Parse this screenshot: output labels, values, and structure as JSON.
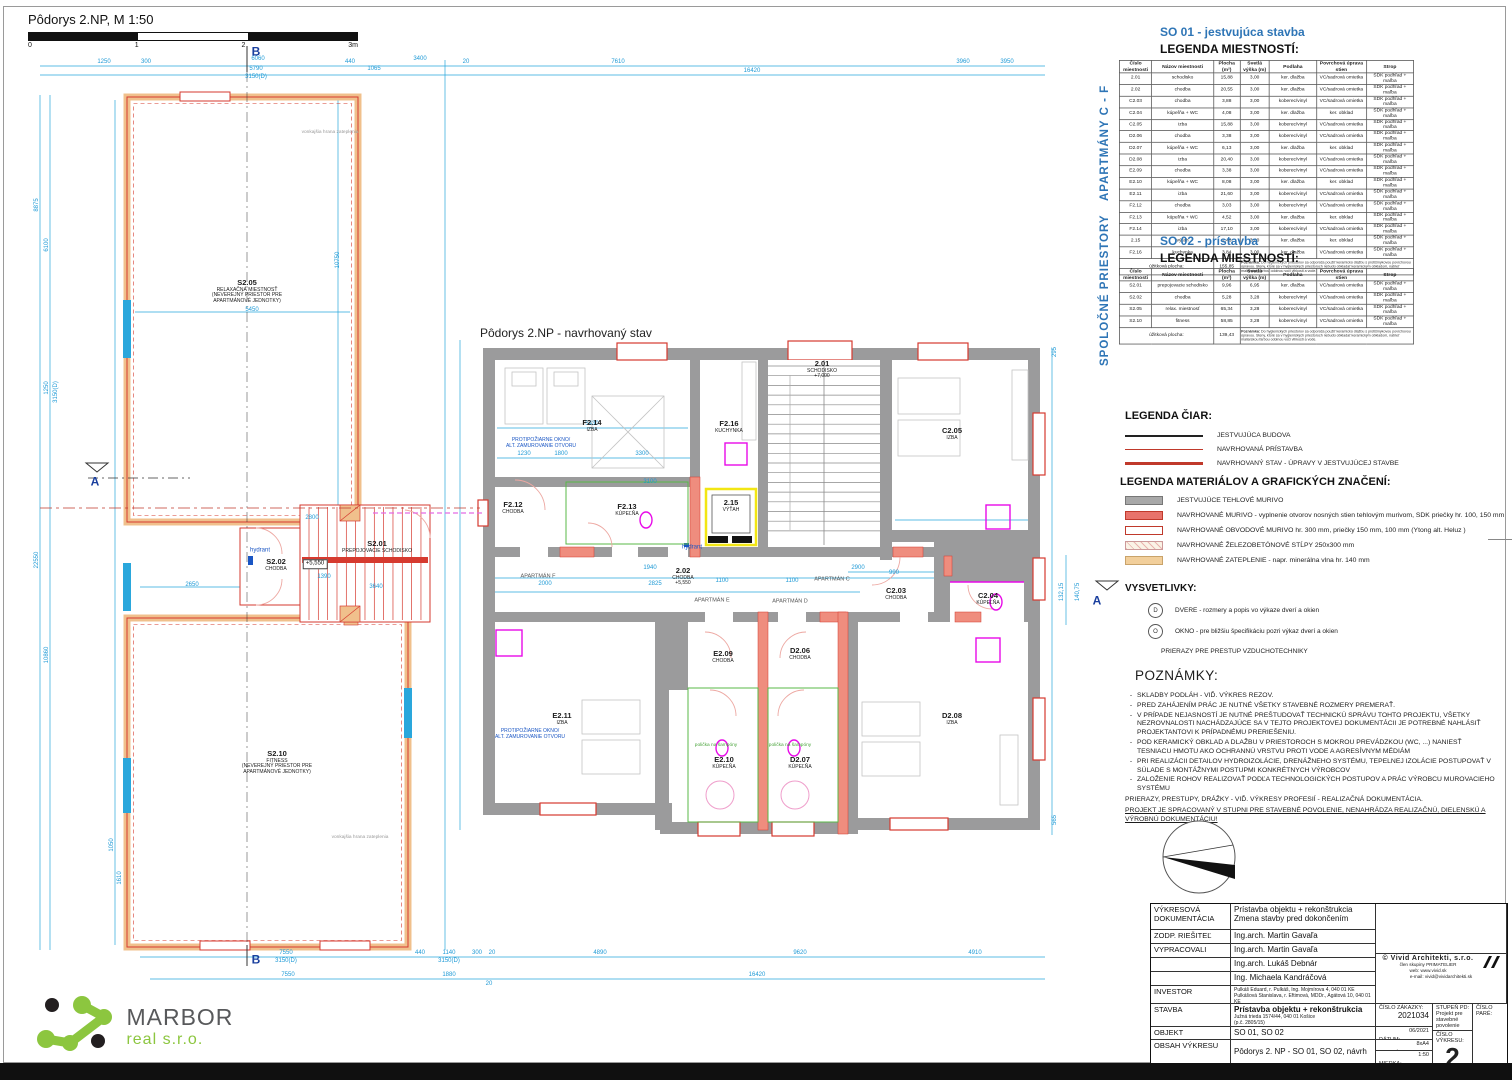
{
  "page": {
    "title": "Pôdorys 2.NP, M 1:50",
    "scale_ticks": [
      "0",
      "1",
      "2",
      "3m"
    ],
    "plan_title": "Pôdorys 2.NP - navrhovaný stav"
  },
  "colors": {
    "cyan": "#1f9ad6",
    "red": "#d63a2f",
    "salmon": "#ef8d7e",
    "tan": "#f0c08c",
    "gray_wall": "#9b9b9c",
    "blue_heading": "#2e75b6",
    "magenta": "#e80ae8",
    "green": "#58b847",
    "yellow": "#f2e613"
  },
  "side_labels": {
    "apartmany": "APARTMÁNY C - F",
    "spolocne": "SPOLOČNÉ PRIESTORY"
  },
  "so01": {
    "heading": "SO 01 - jestvujúca stavba",
    "subheading": "LEGENDA MIESTNOSTÍ:"
  },
  "so02": {
    "heading": "SO 02 - prístavba",
    "subheading": "LEGENDA MIESTNOSTÍ:"
  },
  "tables": {
    "headers": [
      "Číslo miestnosti",
      "Názov miestnosti",
      "Plocha (m²)",
      "Svetlá výška (m)",
      "Podlaha",
      "Povrchová úprava stien",
      "Strop"
    ],
    "so01": {
      "rows": [
        [
          "2.01",
          "schodisko",
          "15,88",
          "3,00",
          "ker. dlažba",
          "VC/sadrová omietka",
          "SDK podhľad + maľba"
        ],
        [
          "2.02",
          "chodba",
          "20,55",
          "3,00",
          "ker. dlažba",
          "VC/sadrová omietka",
          "SDK podhľad + maľba"
        ],
        [
          "C2.03",
          "chodba",
          "3,88",
          "3,00",
          "koberec/vinyl",
          "VC/sadrová omietka",
          "SDK podhľad + maľba"
        ],
        [
          "C2.04",
          "kúpeľňa + WC",
          "4,08",
          "3,00",
          "ker. dlažba",
          "ker. obklad",
          "SDK podhľad + maľba"
        ],
        [
          "C2.05",
          "izba",
          "15,88",
          "3,00",
          "koberec/vinyl",
          "VC/sadrová omietka",
          "SDK podhľad + maľba"
        ],
        [
          "D2.06",
          "chodba",
          "3,38",
          "3,00",
          "koberec/vinyl",
          "VC/sadrová omietka",
          "SDK podhľad + maľba"
        ],
        [
          "D2.07",
          "kúpeľňa + WC",
          "6,13",
          "3,00",
          "ker. dlažba",
          "ker. obklad",
          "SDK podhľad + maľba"
        ],
        [
          "D2.08",
          "izba",
          "20,40",
          "3,00",
          "koberec/vinyl",
          "VC/sadrová omietka",
          "SDK podhľad + maľba"
        ],
        [
          "E2.09",
          "chodba",
          "3,38",
          "3,00",
          "koberec/vinyl",
          "VC/sadrová omietka",
          "SDK podhľad + maľba"
        ],
        [
          "E2.10",
          "kúpeľňa + WC",
          "8,08",
          "3,00",
          "ker. dlažba",
          "ker. obklad",
          "SDK podhľad + maľba"
        ],
        [
          "E2.11",
          "izba",
          "21,60",
          "3,00",
          "koberec/vinyl",
          "VC/sadrová omietka",
          "SDK podhľad + maľba"
        ],
        [
          "F2.12",
          "chodba",
          "3,03",
          "3,00",
          "koberec/vinyl",
          "VC/sadrová omietka",
          "SDK podhľad + maľba"
        ],
        [
          "F2.13",
          "kúpeľňa + WC",
          "4,52",
          "3,00",
          "ker. dlažba",
          "ker. obklad",
          "SDK podhľad + maľba"
        ],
        [
          "F2.14",
          "izba",
          "17,10",
          "3,00",
          "koberec/vinyl",
          "VC/sadrová omietka",
          "SDK podhľad + maľba"
        ],
        [
          "2.15",
          "výťah",
          "2,48",
          "3,00",
          "ker. dlažba",
          "ker. obklad",
          "SDK podhľad + maľba"
        ],
        [
          "F2.16",
          "kuchynka",
          "3,84",
          "3,00",
          "ker. dlažba",
          "VC/sadrová omietka",
          "SDK podhľad + maľba"
        ]
      ],
      "footer": {
        "label": "úžitková plocha:",
        "value": "155,85",
        "note_label": "Poznámka:",
        "note": "Do hygienických priestorov sa odporúča použiť keramickú dlažbu s protišmykovou povrchovou úpravou. Steny, ktoré sa v hygienických priestoroch nebudú obkladať keramickým obkladom, natrieť maliarskou farbou odolnou voči vlhkosti a vode."
      }
    },
    "so02": {
      "rows": [
        [
          "S2.01",
          "prepojovacie schodisko",
          "9,96",
          "6,95",
          "ker. dlažba",
          "VC/sadrová omietka",
          "SDK podhľad + maľba"
        ],
        [
          "S2.02",
          "chodba",
          "5,28",
          "3,28",
          "koberec/vinyl",
          "VC/sadrová omietka",
          "SDK podhľad + maľba"
        ],
        [
          "S2.05",
          "relax. miestnosť",
          "65,34",
          "3,28",
          "koberec/vinyl",
          "VC/sadrová omietka",
          "SDK podhľad + maľba"
        ],
        [
          "S2.10",
          "fitness",
          "58,85",
          "3,28",
          "koberec/vinyl",
          "VC/sadrová omietka",
          "SDK podhľad + maľba"
        ]
      ],
      "footer": {
        "label": "úžitková plocha:",
        "value": "139,43",
        "note_label": "Poznámka:",
        "note": "Do hygienických priestorov sa odporúča použiť keramickú dlažbu s protišmykovou povrchovou úpravou. Steny, ktoré sa v hygienických priestoroch nebudú obkladať keramickým obkladom, natrieť maliarskou farbou odolnou voči vlhkosti a vode."
      }
    }
  },
  "legend_lines": {
    "title": "LEGENDA ČIAR:",
    "items": [
      {
        "label": "JESTVUJÚCA BUDOVA",
        "color": "#222222",
        "weight": 2
      },
      {
        "label": "NAVRHOVANÁ PRÍSTAVBA",
        "color": "#c0392b",
        "weight": 1
      },
      {
        "label": "NAVRHOVANÝ STAV - ÚPRAVY V JESTVUJÚCEJ STAVBE",
        "color": "#c0392b",
        "weight": 3
      }
    ]
  },
  "legend_materials": {
    "title": "LEGENDA MATERIÁLOV A GRAFICKÝCH ZNAČENÍ:",
    "items": [
      {
        "swatch": "gray-fill",
        "label": "JESTVUJÚCE TEHLOVÉ MURIVO"
      },
      {
        "swatch": "red-fill",
        "label": "NAVRHOVANÉ MURIVO - vyplnenie otvorov nosných stien tehlovým murivom, SDK priečky hr. 100, 150 mm"
      },
      {
        "swatch": "red-outline",
        "label": "NAVRHOVANÉ OBVODOVÉ MURIVO hr. 300 mm, priečky 150 mm, 100 mm (Ytong alt. Heluz )"
      },
      {
        "swatch": "hatch",
        "label": "NAVRHOVANÉ ŽELEZOBETÓNOVÉ STĹPY 250x300 mm"
      },
      {
        "swatch": "tan-fill",
        "label": "NAVRHOVANÉ ZATEPLENIE - napr. minerálna vlna hr. 140 mm"
      }
    ]
  },
  "vysvetlivky": {
    "title": "VYSVETLIVKY:",
    "marker": "A",
    "items": [
      {
        "sym": "D",
        "text": "DVERE - rozmery a popis vo výkaze dverí a okien"
      },
      {
        "sym": "O",
        "text": "OKNO - pre bližšiu špecifikáciu pozri výkaz dverí a okien"
      }
    ],
    "extra": "PRIERAZY PRE PRESTUP VZDUCHOTECHNIKY"
  },
  "poznamky": {
    "title": "POZNÁMKY:",
    "bullets": [
      "SKLADBY PODLÁH - VIĎ. VÝKRES REZOV.",
      "PRED ZAHÁJENÍM PRÁC JE NUTNÉ VŠETKY STAVEBNÉ ROZMERY PREMERAŤ.",
      "V PRÍPADE NEJASNOSTÍ JE NUTNÉ PREŠTUDOVAŤ TECHNICKÚ SPRÁVU TOHTO PROJEKTU, VŠETKY NEZROVNALOSTI NACHÁDZAJÚCE SA V TEJTO PROJEKTOVEJ DOKUMENTÁCII JE POTREBNÉ NAHLÁSIŤ PROJEKTANTOVI K PRÍPADNÉMU PRERIEŠENIU.",
      "POD KERAMICKÝ OBKLAD A DLAŽBU V PRIESTOROCH S MOKROU PREVÁDZKOU (WC, ...) NANIESŤ TESNIACU HMOTU AKO OCHRANNÚ VRSTVU PROTI VODE A AGRESÍVNYM MÉDIÁM",
      "PRI REALIZÁCII DETAILOV HYDROIZOLÁCIE, DRENÁŽNEHO SYSTÉMU, TEPELNEJ IZOLÁCIE POSTUPOVAŤ V SÚLADE S MONTÁŽNYMI POSTUPMI KONKRÉTNYCH VÝROBCOV",
      "ZALOŽENIE ROHOV REALIZOVAŤ PODĽA TECHNOLOGICKÝCH POSTUPOV A PRÁC VÝROBCU MUROVACIEHO SYSTÉMU"
    ],
    "line1": "PRIERAZY, PRESTUPY, DRÁŽKY - VIĎ. VÝKRESY PROFESIÍ - REALIZAČNÁ DOKUMENTÁCIA.",
    "line2": "PROJEKT JE SPRACOVANÝ V STUPNI PRE STAVEBNÉ POVOLENIE, NENAHRÁDZA REALIZAČNÚ, DIELENSKÚ A VÝROBNÚ DOKUMENTÁCIU!"
  },
  "rooms": [
    {
      "num": "F2.14",
      "name": "IZBA",
      "sub": [],
      "x": 592,
      "y": 426
    },
    {
      "num": "F2.16",
      "name": "KUCHYNKA",
      "sub": [],
      "x": 729,
      "y": 427
    },
    {
      "num": "F2.12",
      "name": "CHODBA",
      "sub": [],
      "x": 513,
      "y": 508
    },
    {
      "num": "F2.13",
      "name": "KÚPEĽŇA",
      "sub": [],
      "x": 627,
      "y": 510
    },
    {
      "num": "2.15",
      "name": "VÝŤAH",
      "sub": [],
      "x": 731,
      "y": 506
    },
    {
      "num": "2.01",
      "name": "SCHODISKO",
      "sub": [
        "+7,000"
      ],
      "x": 822,
      "y": 370
    },
    {
      "num": "C2.05",
      "name": "IZBA",
      "sub": [],
      "x": 952,
      "y": 434
    },
    {
      "num": "C2.03",
      "name": "CHODBA",
      "sub": [],
      "x": 896,
      "y": 594
    },
    {
      "num": "C2.04",
      "name": "KÚPEĽŇA",
      "sub": [],
      "x": 988,
      "y": 599
    },
    {
      "num": "2.02",
      "name": "CHODBA",
      "sub": [
        "+5,550"
      ],
      "x": 683,
      "y": 577
    },
    {
      "num": "E2.09",
      "name": "CHODBA",
      "sub": [],
      "x": 723,
      "y": 657
    },
    {
      "num": "D2.06",
      "name": "CHODBA",
      "sub": [],
      "x": 800,
      "y": 654
    },
    {
      "num": "E2.11",
      "name": "IZBA",
      "sub": [],
      "x": 562,
      "y": 719
    },
    {
      "num": "E2.10",
      "name": "KÚPEĽŇA",
      "sub": [],
      "x": 724,
      "y": 763
    },
    {
      "num": "D2.07",
      "name": "KÚPEĽŇA",
      "sub": [],
      "x": 800,
      "y": 763
    },
    {
      "num": "D2.08",
      "name": "IZBA",
      "sub": [],
      "x": 952,
      "y": 719
    },
    {
      "num": "S2.05",
      "name": "RELAXAČNÁ MIESTNOSŤ",
      "sub": [
        "(NEVEREJNÝ PRIESTOR PRE",
        "APARTMÁNOVÉ JEDNOTKY)"
      ],
      "x": 247,
      "y": 292
    },
    {
      "num": "S2.02",
      "name": "CHODBA",
      "sub": [],
      "x": 276,
      "y": 565
    },
    {
      "num": "S2.01",
      "name": "PREPOJOVACIE SCHODISKO",
      "sub": [],
      "x": 377,
      "y": 547
    },
    {
      "num": "S2.10",
      "name": "FITNESS",
      "sub": [
        "(NEVEREJNÝ PRIESTOR PRE",
        "APARTMÁNOVÉ JEDNOTKY)"
      ],
      "x": 277,
      "y": 763
    }
  ],
  "labels": [
    {
      "cls": "hydrant",
      "t": "hydrant",
      "x": 260,
      "y": 551
    },
    {
      "cls": "hydrant",
      "t": "hydrant",
      "x": 692,
      "y": 548
    },
    {
      "cls": "bluenote",
      "t": "PROTIPOŽIARNE OKNO/\nALT. ZAMUROVANIE OTVORU",
      "x": 541,
      "y": 443
    },
    {
      "cls": "bluenote",
      "t": "PROTIPOŽIARNE OKNO/\nALT. ZAMUROVANIE OTVORU",
      "x": 530,
      "y": 734
    },
    {
      "cls": "greennote",
      "t": "polička na šampóny",
      "x": 716,
      "y": 746
    },
    {
      "cls": "greennote",
      "t": "polička na šampóny",
      "x": 790,
      "y": 746
    },
    {
      "cls": "graynote",
      "t": "vonkajšia hrana zateplenia",
      "x": 330,
      "y": 133
    },
    {
      "cls": "graynote",
      "t": "vonkajšia hrana zateplenia",
      "x": 360,
      "y": 838
    },
    {
      "cls": "apt",
      "t": "APARTMÁN F",
      "x": 538,
      "y": 577
    },
    {
      "cls": "apt",
      "t": "APARTMÁN E",
      "x": 712,
      "y": 601
    },
    {
      "cls": "apt",
      "t": "APARTMÁN D",
      "x": 790,
      "y": 602
    },
    {
      "cls": "apt",
      "t": "APARTMÁN C",
      "x": 832,
      "y": 580
    },
    {
      "cls": "level",
      "t": "+5,550",
      "x": 315,
      "y": 564
    },
    {
      "cls": "secmark",
      "t": "B",
      "x": 256,
      "y": 52
    },
    {
      "cls": "secmark",
      "t": "B",
      "x": 256,
      "y": 960
    },
    {
      "cls": "secmark",
      "t": "A",
      "x": 95,
      "y": 482
    },
    {
      "cls": "secmark",
      "t": "A",
      "x": 1097,
      "y": 601
    }
  ],
  "dims": [
    {
      "t": "1250",
      "x": 104,
      "y": 62
    },
    {
      "t": "300",
      "x": 146,
      "y": 62
    },
    {
      "t": "6060",
      "x": 258,
      "y": 59
    },
    {
      "t": "5790",
      "x": 256,
      "y": 69
    },
    {
      "t": "3150(D)",
      "x": 256,
      "y": 77
    },
    {
      "t": "440",
      "x": 350,
      "y": 62
    },
    {
      "t": "3400",
      "x": 420,
      "y": 59
    },
    {
      "t": "1065",
      "x": 374,
      "y": 69
    },
    {
      "t": "20",
      "x": 466,
      "y": 62
    },
    {
      "t": "7610",
      "x": 618,
      "y": 62
    },
    {
      "t": "16420",
      "x": 752,
      "y": 71
    },
    {
      "t": "3960",
      "x": 963,
      "y": 62
    },
    {
      "t": "3950",
      "x": 1007,
      "y": 62
    },
    {
      "t": "8875",
      "x": 37,
      "y": 205,
      "r": 1
    },
    {
      "t": "6100",
      "x": 47,
      "y": 245,
      "r": 1
    },
    {
      "t": "1250",
      "x": 47,
      "y": 388,
      "r": 1
    },
    {
      "t": "3150(D)",
      "x": 56,
      "y": 392,
      "r": 1
    },
    {
      "t": "22550",
      "x": 37,
      "y": 560,
      "r": 1
    },
    {
      "t": "10860",
      "x": 47,
      "y": 655,
      "r": 1
    },
    {
      "t": "1610",
      "x": 120,
      "y": 878,
      "r": 1
    },
    {
      "t": "1050",
      "x": 112,
      "y": 845,
      "r": 1
    },
    {
      "t": "7550",
      "x": 286,
      "y": 953
    },
    {
      "t": "3150(D)",
      "x": 286,
      "y": 961
    },
    {
      "t": "440",
      "x": 420,
      "y": 953
    },
    {
      "t": "1140",
      "x": 449,
      "y": 953
    },
    {
      "t": "3150(D)",
      "x": 449,
      "y": 961
    },
    {
      "t": "300",
      "x": 477,
      "y": 953
    },
    {
      "t": "20",
      "x": 492,
      "y": 953
    },
    {
      "t": "4890",
      "x": 600,
      "y": 953
    },
    {
      "t": "9620",
      "x": 800,
      "y": 953
    },
    {
      "t": "4910",
      "x": 975,
      "y": 953
    },
    {
      "t": "7550",
      "x": 288,
      "y": 975
    },
    {
      "t": "1880",
      "x": 449,
      "y": 975
    },
    {
      "t": "20",
      "x": 489,
      "y": 984
    },
    {
      "t": "16420",
      "x": 757,
      "y": 975
    },
    {
      "t": "295",
      "x": 1055,
      "y": 352,
      "r": 1
    },
    {
      "t": "132,15",
      "x": 1062,
      "y": 592,
      "r": 1
    },
    {
      "t": "140,75",
      "x": 1078,
      "y": 592,
      "r": 1
    },
    {
      "t": "565",
      "x": 1055,
      "y": 820,
      "r": 1
    },
    {
      "t": "5430",
      "x": 592,
      "y": 424
    },
    {
      "t": "1230",
      "x": 524,
      "y": 454
    },
    {
      "t": "1800",
      "x": 561,
      "y": 454
    },
    {
      "t": "3300",
      "x": 642,
      "y": 454
    },
    {
      "t": "3100",
      "x": 650,
      "y": 482
    },
    {
      "t": "2000",
      "x": 545,
      "y": 584
    },
    {
      "t": "2825",
      "x": 655,
      "y": 584
    },
    {
      "t": "1100",
      "x": 722,
      "y": 581
    },
    {
      "t": "1100",
      "x": 792,
      "y": 581
    },
    {
      "t": "2900",
      "x": 858,
      "y": 568
    },
    {
      "t": "990",
      "x": 894,
      "y": 573
    },
    {
      "t": "1940",
      "x": 650,
      "y": 568
    },
    {
      "t": "5450",
      "x": 252,
      "y": 310
    },
    {
      "t": "2800",
      "x": 312,
      "y": 518
    },
    {
      "t": "2650",
      "x": 192,
      "y": 585
    },
    {
      "t": "3640",
      "x": 376,
      "y": 587
    },
    {
      "t": "1390",
      "x": 324,
      "y": 577
    },
    {
      "t": "10750",
      "x": 338,
      "y": 260,
      "r": 1
    }
  ],
  "titleblock": {
    "doc_label": "VÝKRESOVÁ DOKUMENTÁCIA",
    "doc_value1": "Prístavba objektu + rekonštrukcia",
    "doc_value2": "Zmena stavby pred dokončením",
    "zodp_label": "ZODP. RIEŠITEĽ",
    "zodp_value": "Ing.arch. Martin Gavaľa",
    "vyprac_label": "VYPRACOVALI",
    "vyprac1": "Ing.arch. Martin Gavaľa",
    "vyprac2": "Ing.arch. Lukáš Debnár",
    "vyprac3": "Ing. Michaela Kandráčová",
    "investor_label": "INVESTOR",
    "investor1": "Pulkáš Eduard, r. Pulkáš, Ing. Mojmírova 4, 040 01 KE",
    "investor2": "Pulkášová Stanislava, r. Eftimová, MDDr., Agátová 10, 040 01 KE",
    "stavba_label": "STAVBA",
    "stavba_value": "Prístavba objektu + rekonštrukcia",
    "stavba_addr1": "Južná trieda 1574/44, 040 01 Košice",
    "stavba_addr2": "(p.č. 2805/15)",
    "zakazka_label": "ČÍSLO ZÁKAZKY:",
    "zakazka_value": "2021034",
    "objekt_label": "OBJEKT",
    "objekt_value": "SO 01, SO 02",
    "obsah_label": "OBSAH VÝKRESU",
    "obsah_value": "Pôdorys 2. NP - SO 01, SO 02, návrh",
    "datum_label": "DÁTUM:",
    "datum_value": "06/2021",
    "format_label": "FORMÁT:",
    "format_value": "8xA4",
    "mierka_label": "MIERKA:",
    "mierka_value": "1:50",
    "stupen_label": "STUPEŇ PD:",
    "stupen_value": "Projekt pre stavebné povolenie",
    "cislo_vykresu_label": "ČÍSLO VÝKRESU:",
    "cislo_vykresu_value": "2",
    "pare_label": "ČÍSLO PARÉ:",
    "firm_name": "© Vivid Architekti, s.r.o.",
    "firm_line1": "člen skupiny PRIMATELIER",
    "firm_line2": "web: www.vivid.sk",
    "firm_line3": "e-mail: vivid@vividarchitekti.sk"
  },
  "logo": {
    "name": "MARBOR",
    "sub": "real s.r.o."
  }
}
